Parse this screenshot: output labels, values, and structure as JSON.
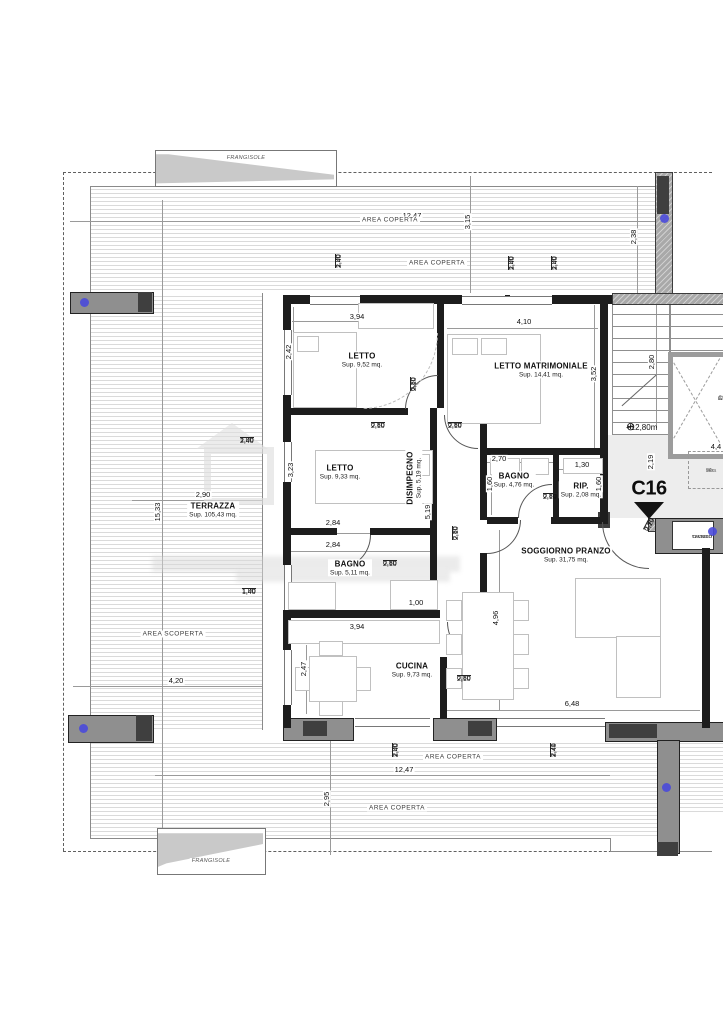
{
  "labels": {
    "rooms": [
      {
        "id": "letto-1",
        "label": "LETTO",
        "area": "Sup. 9,52 mq.",
        "x": 362,
        "y": 360
      },
      {
        "id": "letto-matrimoniale",
        "label": "LETTO MATRIMONIALE",
        "area": "Sup. 14,41 mq.",
        "x": 541,
        "y": 370
      },
      {
        "id": "letto-2",
        "label": "LETTO",
        "area": "Sup. 9,33 mq.",
        "x": 340,
        "y": 472
      },
      {
        "id": "disimpegno",
        "label": "DISIMPEGNO",
        "area": "Sup. 5,19 mq.",
        "x": 414,
        "y": 478,
        "rot": -90
      },
      {
        "id": "bagno-1",
        "label": "BAGNO",
        "area": "Sup. 5,11 mq.",
        "x": 350,
        "y": 568
      },
      {
        "id": "bagno-2",
        "label": "BAGNO",
        "area": "Sup. 4,76 mq.",
        "x": 514,
        "y": 480
      },
      {
        "id": "ripostiglio",
        "label": "RIP.",
        "area": "Sup. 2,08 mq.",
        "x": 581,
        "y": 490
      },
      {
        "id": "soggiorno-pranzo",
        "label": "SOGGIORNO PRANZO",
        "area": "Sup. 31,75 mq.",
        "x": 566,
        "y": 555
      },
      {
        "id": "cucina",
        "label": "CUCINA",
        "area": "Sup. 9,73 mq.",
        "x": 412,
        "y": 670
      },
      {
        "id": "terrazza",
        "label": "TERRAZZA",
        "area": "Sup. 105,43 mq.",
        "x": 213,
        "y": 510
      }
    ],
    "dims": [
      [
        "3,94",
        357,
        317
      ],
      [
        "2,42",
        289,
        352,
        -90
      ],
      [
        "4,10",
        524,
        322
      ],
      [
        "3,52",
        594,
        374,
        -90
      ],
      [
        "2,84",
        333,
        523
      ],
      [
        "2,84",
        333,
        545
      ],
      [
        "3,23",
        291,
        470,
        -90
      ],
      [
        "5,19",
        428,
        512,
        -90
      ],
      [
        "2,70",
        499,
        459
      ],
      [
        "1,60",
        490,
        484,
        -90
      ],
      [
        "1,30",
        582,
        465
      ],
      [
        "1,60",
        599,
        484,
        -90
      ],
      [
        "4,96",
        496,
        618,
        -90
      ],
      [
        "6,48",
        572,
        704
      ],
      [
        "3,94",
        357,
        627
      ],
      [
        "2,47",
        304,
        669,
        -90
      ],
      [
        "1,00",
        416,
        603
      ],
      [
        "2,90",
        203,
        495
      ],
      [
        "15,33",
        158,
        512,
        -90
      ],
      [
        "4,20",
        176,
        681
      ],
      [
        "12,47",
        412,
        216
      ],
      [
        "3,15",
        468,
        222,
        -90
      ],
      [
        "2,38",
        634,
        237,
        -90
      ],
      [
        "12,47",
        404,
        770
      ],
      [
        "2,95",
        327,
        799,
        -90
      ],
      [
        "2,80",
        652,
        362,
        -90
      ],
      [
        "2,19",
        651,
        462,
        -90
      ],
      [
        "4,4",
        716,
        447
      ]
    ],
    "fracs": [
      [
        "0,80",
        "2,10",
        371,
        422
      ],
      [
        "0,80",
        "2,10",
        448,
        422
      ],
      [
        "0,80",
        "2,10",
        410,
        391,
        -90
      ],
      [
        "0,80",
        "2,10",
        383,
        560
      ],
      [
        "0,80",
        "2,10",
        543,
        493
      ],
      [
        "0,80",
        "2,10",
        452,
        540,
        -90
      ],
      [
        "0,80",
        "2,10",
        457,
        675
      ],
      [
        "0,90",
        "2,10",
        643,
        529,
        -62
      ],
      [
        "1,00",
        "2,40",
        335,
        268,
        -90
      ],
      [
        "1,00",
        "2,40",
        508,
        270,
        -90
      ],
      [
        "1,00",
        "2,40",
        551,
        270,
        -90
      ],
      [
        "1,00",
        "2,40",
        240,
        437
      ],
      [
        "1,00",
        "1,40",
        242,
        588
      ],
      [
        "2,00",
        "2,40",
        392,
        757,
        -90
      ],
      [
        "2,71",
        "2,40",
        550,
        757,
        -90
      ]
    ],
    "areas": [
      [
        "AREA COPERTA",
        390,
        220
      ],
      [
        "AREA COPERTA",
        437,
        263
      ],
      [
        "AREA SCOPERTA",
        173,
        634
      ],
      [
        "AREA COPERTA",
        453,
        757
      ],
      [
        "AREA COPERTA",
        397,
        808
      ],
      [
        "FRANGISOLE",
        246,
        158
      ],
      [
        "FRANGISOLE",
        211,
        861
      ]
    ],
    "annotations": {
      "unit_code": "C16",
      "level": "+12,80m",
      "benchmark_icon": "⊕",
      "elevator_1": "ASCENSORE",
      "elevator_2": "CONDOMINIALE",
      "cavedio_1": "CAVEDIO",
      "cavedio_2": "TECNICO",
      "note_1": "94",
      "note_2": "retra",
      "note_3": "70x"
    }
  }
}
